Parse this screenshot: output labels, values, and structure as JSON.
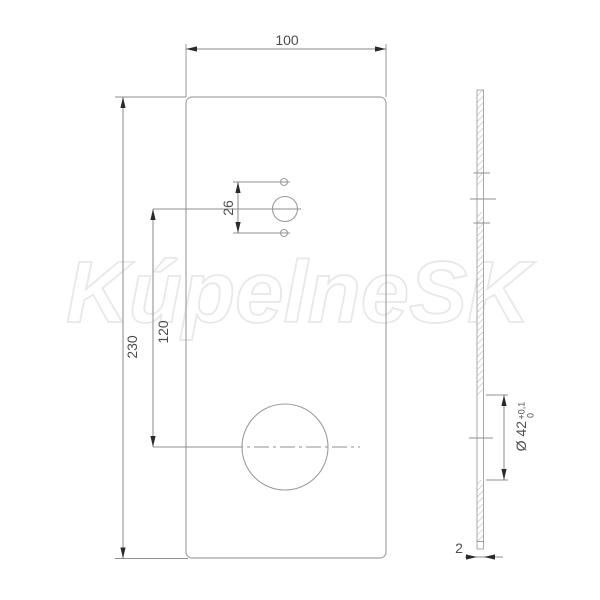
{
  "watermark": {
    "text": "KúpelneSK"
  },
  "front_view": {
    "width_dim_label": "100",
    "height_dim_label": "230",
    "hole_center_dim_label": "120",
    "pin_hole_spacing_dim_label": "26"
  },
  "side_view": {
    "hole_diameter_label": "Ø 42",
    "tolerance_upper": "+0,1",
    "tolerance_lower": "0",
    "thickness_dim_label": "2"
  },
  "colors": {
    "background": "#ffffff",
    "outline": "#a3a3a3",
    "dimension_line": "#8a8a8a",
    "text": "#4d4d4d",
    "arrow": "#2a2a2a",
    "watermark_stroke": "#e8e8e8"
  }
}
